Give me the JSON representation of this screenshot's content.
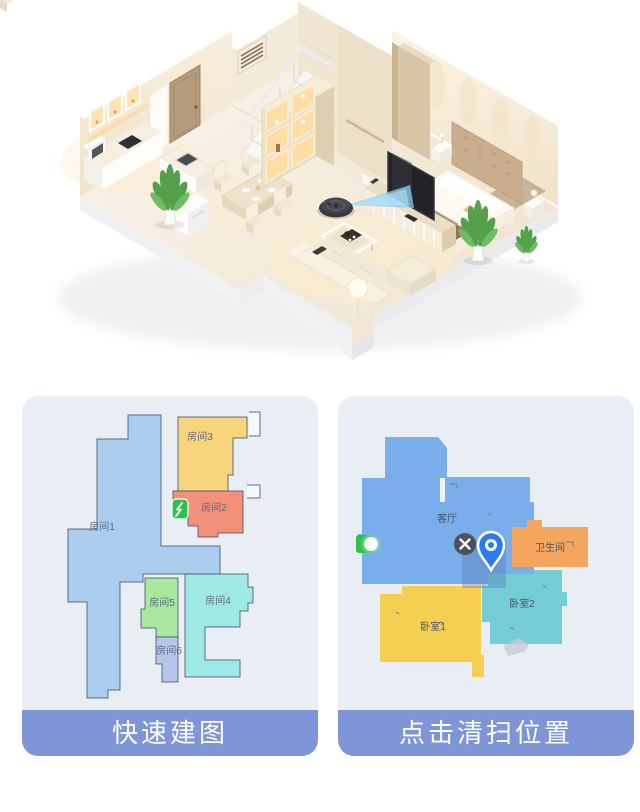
{
  "panels": {
    "left": {
      "caption": "快速建图",
      "rooms": [
        {
          "id": "room1",
          "label": "房间1",
          "color": "#aacdf0"
        },
        {
          "id": "room2",
          "label": "房间2",
          "color": "#f2907a"
        },
        {
          "id": "room3",
          "label": "房间3",
          "color": "#f8d47c"
        },
        {
          "id": "room4",
          "label": "房间4",
          "color": "#9fe9e4"
        },
        {
          "id": "room5",
          "label": "房间5",
          "color": "#a8e79e"
        },
        {
          "id": "room6",
          "label": "房间6",
          "color": "#b9c4ec"
        }
      ],
      "icons": [
        {
          "name": "dock-icon",
          "color": "#2fbf4f"
        }
      ]
    },
    "right": {
      "caption": "点击清扫位置",
      "rooms": [
        {
          "id": "living-room",
          "label": "客厅",
          "color": "#79aeea"
        },
        {
          "id": "bathroom",
          "label": "卫生间",
          "color": "#f4a55e"
        },
        {
          "id": "bedroom1",
          "label": "卧室1",
          "color": "#f4cf52"
        },
        {
          "id": "bedroom2",
          "label": "卧室2",
          "color": "#74ccd4"
        }
      ],
      "icons": [
        {
          "name": "dock-icon",
          "color": "#2fbf4f"
        },
        {
          "name": "close-icon",
          "color": "#46474d"
        },
        {
          "name": "location-pin-icon",
          "color": "#2e7bf0"
        }
      ],
      "highlight_color": "#4e6ea8"
    }
  },
  "scene_icons": [
    {
      "name": "robot-vacuum-icon",
      "beam_color": "#8fd0f2"
    }
  ],
  "colors": {
    "caption_bar": "#7e96d8",
    "panel_bg": "#e9eef5",
    "pin": "#2e7bf0",
    "dock_green": "#2fbf4f",
    "close_button": "#46474d"
  }
}
